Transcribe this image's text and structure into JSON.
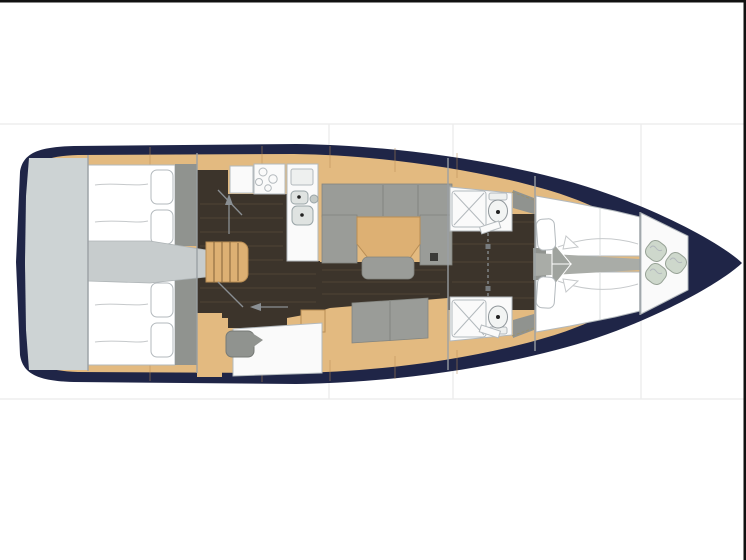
{
  "colors": {
    "background": "#ffffff",
    "frame_edge": "#111111",
    "seam_line": "#ededed",
    "hull_navy": "#1f2547",
    "wood": "#e3ba80",
    "wood_edge": "#b98e55",
    "steps_wood": "#ddb073",
    "floor_dark": "#3c342b",
    "floor_grain": "#6a5a45",
    "white_surface": "#fafafa",
    "white_bed": "#ffffff",
    "outline": "#b3b9bd",
    "upholstery_gray": "#9a9c98",
    "cabinet_gray": "#90938f",
    "corridor_gray": "#c7cccd",
    "transom_gray": "#cdd3d4",
    "cushion_sage": "#ced8cc",
    "sage_edge": "#97a296",
    "fixture_gray": "#eef0ef",
    "arrow_gray": "#8a8f93",
    "bulkhead": "#9aa0a4",
    "sheet_line": "#c6c9cb",
    "dot_black": "#222222"
  }
}
